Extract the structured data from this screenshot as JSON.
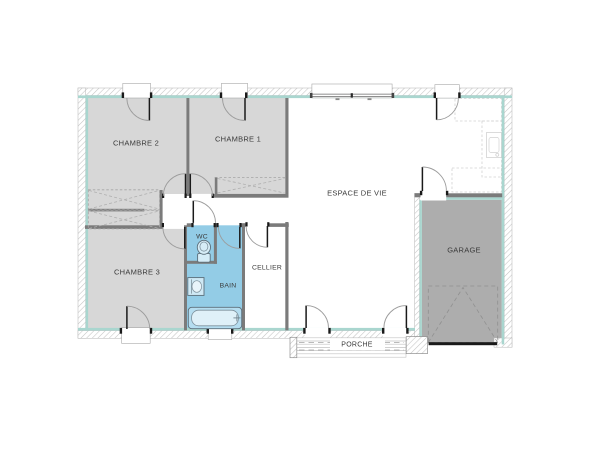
{
  "floor_plan": {
    "rooms": {
      "chambre1": {
        "label": "CHAMBRE 1"
      },
      "chambre2": {
        "label": "CHAMBRE 2"
      },
      "chambre3": {
        "label": "CHAMBRE 3"
      },
      "wc": {
        "label": "WC"
      },
      "bain": {
        "label": "BAIN"
      },
      "cellier": {
        "label": "CELLIER"
      },
      "espace_de_vie": {
        "label": "ESPACE DE VIE"
      },
      "garage": {
        "label": "GARAGE"
      },
      "porche": {
        "label": "PORCHE"
      }
    },
    "fixtures": [
      "toilet",
      "sink",
      "bathtub",
      "kitchen-sink"
    ],
    "colors": {
      "room_fill": "#d7d7d7",
      "wet_room_fill": "#93cce6",
      "garage_fill": "#adadad",
      "interior_wall": "#7b7b7b",
      "teal_liner": "#a9d6cf",
      "hatch_line": "#c4c4c4",
      "door_leaf": "#1a1a1a"
    }
  }
}
